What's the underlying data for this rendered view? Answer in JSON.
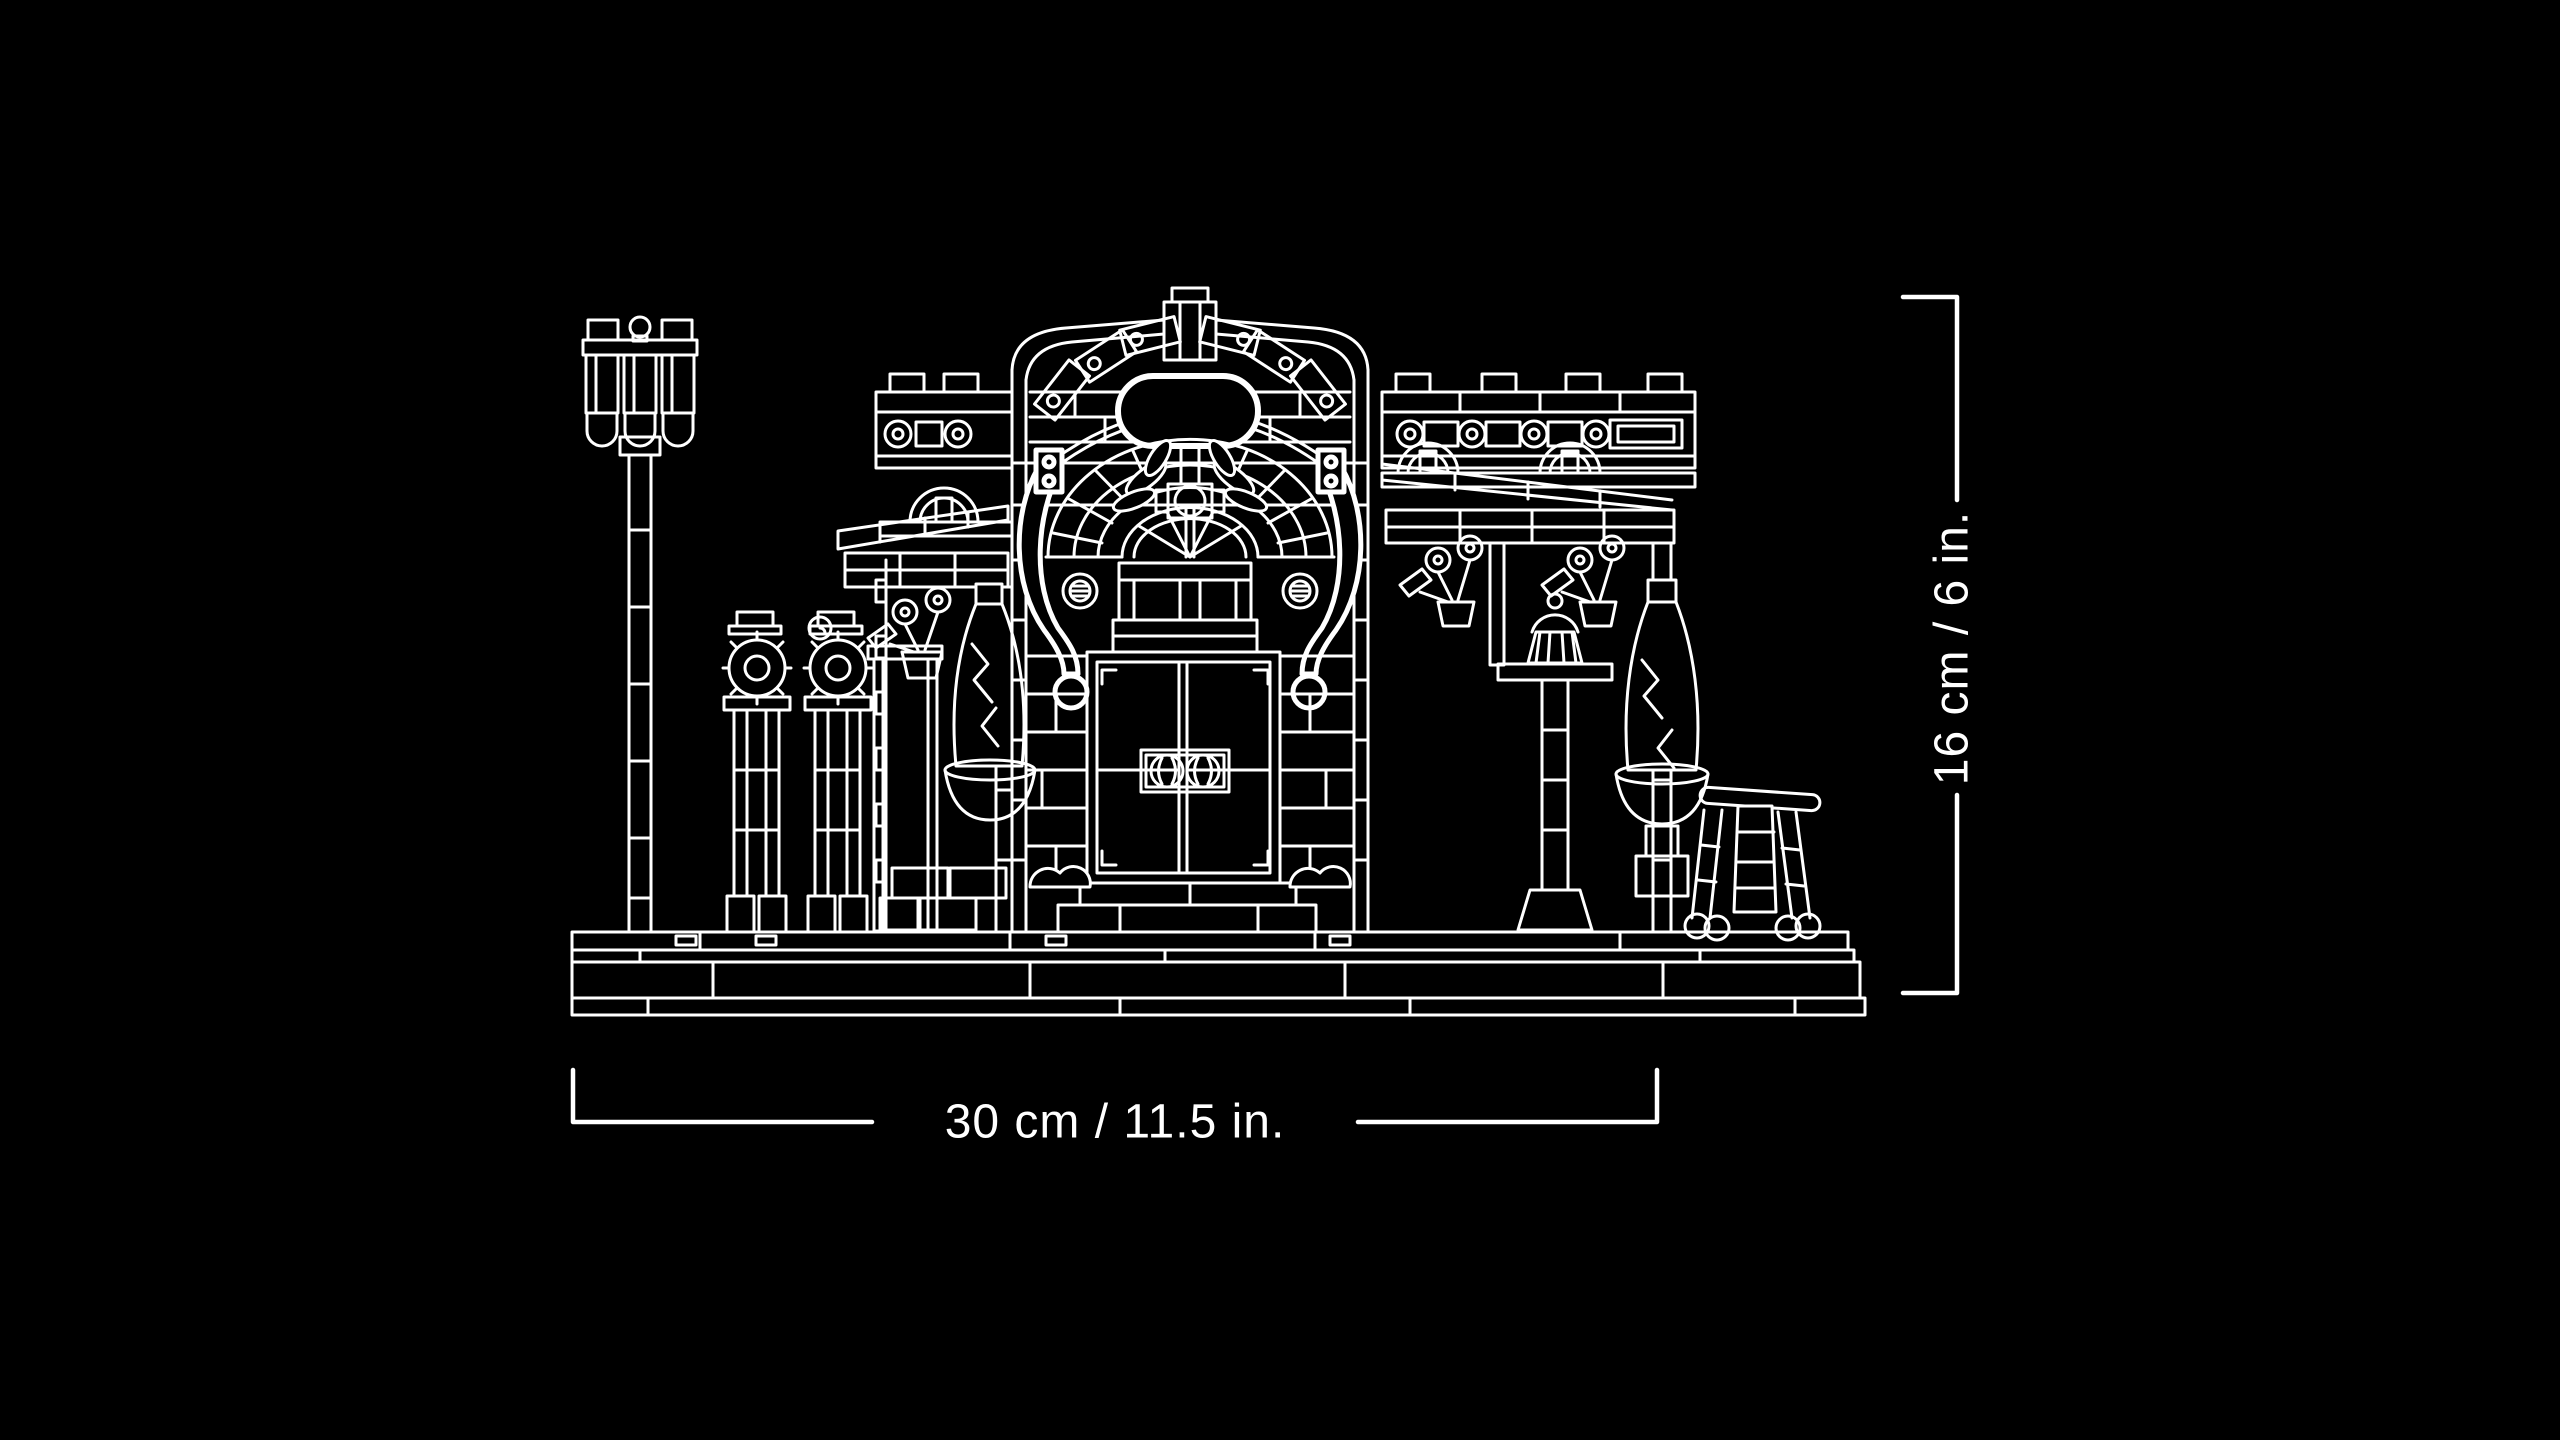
{
  "page": {
    "type": "product-dimension-diagram",
    "background_color": "#000000",
    "line_color": "#ffffff"
  },
  "artwork": {
    "subject": "White wireframe line drawing of an ornate LEGO shop facade",
    "elements": [
      "street lamp with three lanterns",
      "two flower stands",
      "central arched pavilion with oval sign and fan window",
      "double entrance doors with round handles",
      "left awning wing with scroll cornice",
      "right awning wing with cafe table and cupcake",
      "potted cone trees",
      "folding deck chair",
      "layered baseplate"
    ]
  },
  "dimension_annotations": {
    "width_label": "30 cm / 11.5 in.",
    "height_label": "16 cm / 6 in."
  }
}
